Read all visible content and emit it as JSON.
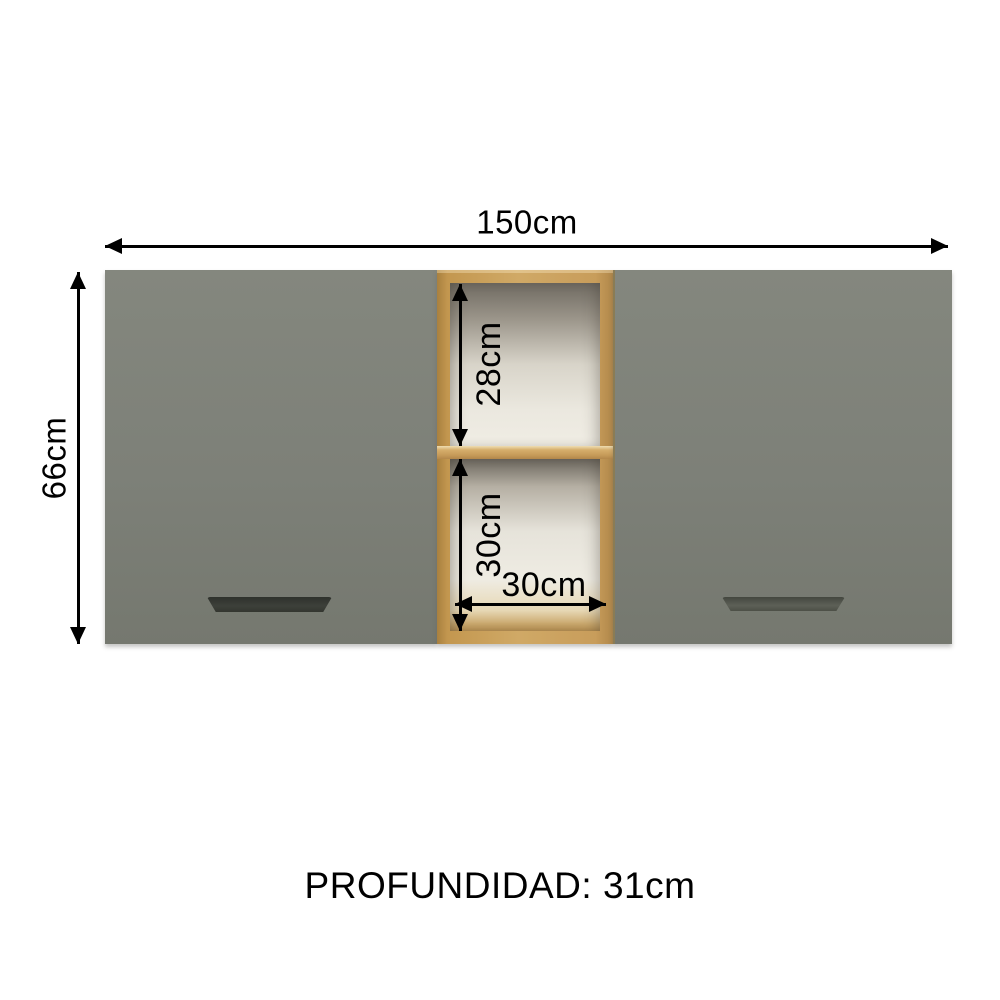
{
  "diagram": {
    "labels": {
      "overall_width": "150cm",
      "overall_height": "66cm",
      "upper_compartment_height": "28cm",
      "lower_compartment_height": "30cm",
      "compartment_width": "30cm",
      "depth": "PROFUNDIDAD: 31cm"
    },
    "colors": {
      "background": "#ffffff",
      "door_gray": "#7d8078",
      "wood_frame": "#c79e60",
      "shelf_highlight": "#eeddb2",
      "interior_light": "#efece3",
      "interior_shadow": "#6f6a61",
      "handle_left": "#34372f",
      "handle_right": "#565a51",
      "dimension_lines": "#000000"
    }
  }
}
